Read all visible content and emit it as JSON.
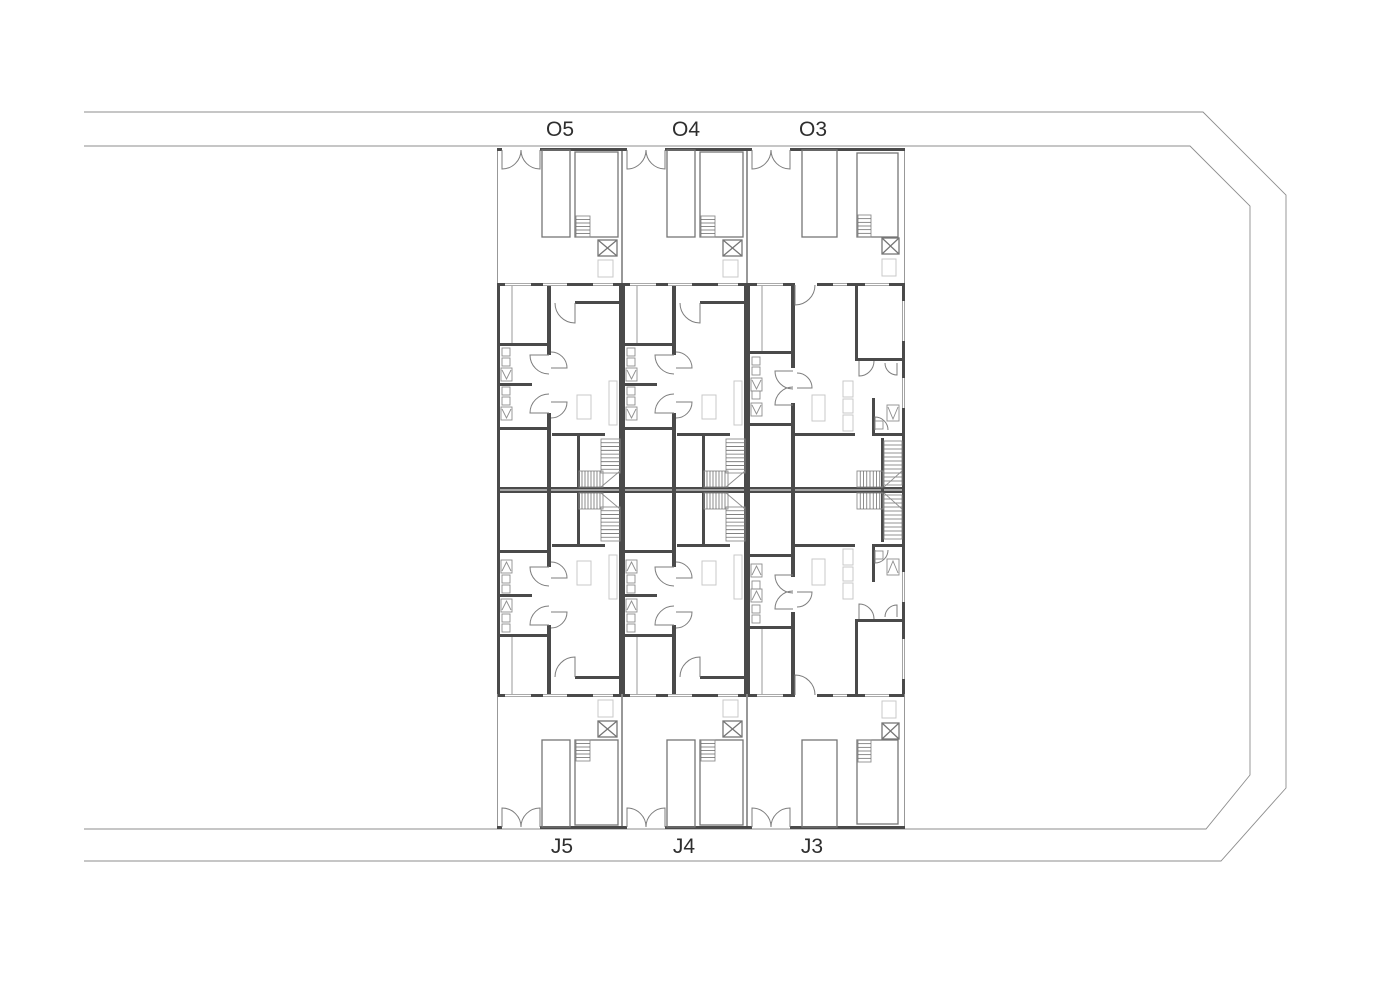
{
  "document": {
    "type": "architectural-site-floor-plan",
    "background": "#ffffff"
  },
  "labels": {
    "top_units": [
      "O5",
      "O4",
      "O3"
    ],
    "bottom_units": [
      "J5",
      "J4",
      "J3"
    ],
    "top_y": 136,
    "bottom_y": 853,
    "font_size": 21,
    "color": "#2e2e2e"
  },
  "colors": {
    "thin_line": "#8d8d8d",
    "medium_line": "#757575",
    "wall_fill": "#4a4a4a",
    "faint_detail": "#c9c9c9",
    "label_text": "#2e2e2e",
    "background": "#ffffff"
  },
  "drawing": {
    "canvas": {
      "w": 1400,
      "h": 989
    },
    "site_boundary": {
      "outer_path": "M 84 112 H 1203 L 1286 195 V 788 L 1221 861 H 84",
      "inner_path": "M 84 146 H 1190 L 1250 206 V 775 L 1206 829 H 84"
    },
    "rows": {
      "courtyard_top_y": 148,
      "dwelling_top_y": 283,
      "mid_y": 490,
      "dwelling_bottom_end": 697,
      "street_bottom_y": 829,
      "courtyard_h": 135,
      "dwelling_h": 207
    },
    "columns": [
      {
        "x": 497,
        "w": 125,
        "type": "A",
        "label_top": "O5",
        "label_bottom": "J5",
        "label_x_top": 560,
        "label_x_bottom": 562
      },
      {
        "x": 622,
        "w": 125,
        "type": "A",
        "label_top": "O4",
        "label_bottom": "J4",
        "label_x_top": 686,
        "label_x_bottom": 684
      },
      {
        "x": 747,
        "w": 158,
        "type": "B",
        "label_top": "O3",
        "label_bottom": "J3",
        "label_x_top": 813,
        "label_x_bottom": 812
      }
    ],
    "templates": {
      "A": {
        "courtyard": [
          [
            "l",
            0.5,
            0,
            0.5,
            135
          ],
          [
            "l",
            124.5,
            0,
            124.5,
            135
          ],
          [
            "w",
            0,
            0,
            5,
            3
          ],
          [
            "w",
            43,
            0,
            82,
            3
          ],
          [
            "a",
            5,
            2,
            19,
            "s",
            "e"
          ],
          [
            "a",
            43,
            2,
            19,
            "s",
            "w"
          ],
          [
            "r",
            45,
            2,
            28,
            87
          ],
          [
            "r",
            78,
            4,
            43,
            85
          ],
          [
            "hh",
            79,
            68,
            14,
            21,
            5
          ],
          [
            "x",
            101,
            92,
            19,
            16
          ],
          [
            "f",
            101,
            112,
            15,
            17
          ]
        ],
        "dwelling": [
          [
            "w",
            0,
            0,
            125,
            3
          ],
          [
            "w",
            0,
            0,
            3,
            207
          ],
          [
            "w",
            122,
            0,
            3,
            207
          ],
          [
            "w",
            0,
            204,
            125,
            2.5
          ],
          [
            "w",
            0,
            60,
            53,
            3
          ],
          [
            "w",
            0,
            100,
            35,
            3
          ],
          [
            "w",
            0,
            144,
            53,
            3
          ],
          [
            "w",
            50,
            0,
            4,
            72
          ],
          [
            "w",
            50,
            130,
            4,
            77
          ],
          [
            "w",
            78,
            18,
            47,
            3
          ],
          [
            "w",
            55,
            150,
            53,
            3
          ],
          [
            "w",
            80,
            153,
            3,
            51
          ],
          [
            "win",
            8,
            0,
            26,
            3
          ],
          [
            "win",
            46,
            0,
            24,
            3
          ],
          [
            "win",
            96,
            0,
            20,
            3
          ],
          [
            "l",
            15,
            3,
            15,
            60
          ],
          [
            "a",
            78,
            20,
            20,
            "s",
            "w"
          ],
          [
            "a",
            52,
            72,
            19,
            "w",
            "s"
          ],
          [
            "a",
            52,
            130,
            19,
            "w",
            "n"
          ],
          [
            "a",
            54,
            85,
            16,
            "e",
            "n"
          ],
          [
            "a",
            54,
            119,
            16,
            "e",
            "s"
          ],
          [
            "sq",
            5,
            65,
            8,
            8
          ],
          [
            "sq",
            5,
            75,
            8,
            8
          ],
          [
            "V",
            4,
            85,
            11,
            13
          ],
          [
            "sq",
            5,
            104,
            8,
            8
          ],
          [
            "sq",
            5,
            114,
            8,
            8
          ],
          [
            "V",
            4,
            124,
            11,
            13
          ],
          [
            "f",
            80,
            112,
            14,
            24
          ],
          [
            "f",
            112,
            98,
            8,
            44
          ],
          [
            "hh",
            104,
            156,
            19,
            34,
            8
          ],
          [
            "hv",
            82,
            188,
            24,
            16,
            7
          ],
          [
            "l",
            104,
            204,
            123,
            188
          ]
        ]
      },
      "B": {
        "courtyard": [
          [
            "l",
            0.5,
            0,
            0.5,
            135
          ],
          [
            "l",
            157.5,
            0,
            157.5,
            135
          ],
          [
            "w",
            0,
            0,
            5,
            3
          ],
          [
            "w",
            43,
            0,
            115,
            3
          ],
          [
            "a",
            5,
            2,
            19,
            "s",
            "e"
          ],
          [
            "a",
            43,
            2,
            19,
            "s",
            "w"
          ],
          [
            "r",
            55,
            2,
            35,
            87
          ],
          [
            "r",
            110,
            5,
            41,
            84
          ],
          [
            "hh",
            111,
            67,
            13,
            22,
            5
          ],
          [
            "x",
            135,
            90,
            17,
            16
          ],
          [
            "f",
            135,
            111,
            14,
            17
          ]
        ],
        "dwelling": [
          [
            "w",
            0,
            0,
            48,
            3
          ],
          [
            "w",
            70,
            0,
            88,
            3
          ],
          [
            "w",
            0,
            0,
            3,
            207
          ],
          [
            "w",
            155,
            0,
            3,
            207
          ],
          [
            "w",
            0,
            204,
            158,
            2.5
          ],
          [
            "w",
            0,
            68,
            44,
            3
          ],
          [
            "w",
            0,
            140,
            44,
            3
          ],
          [
            "w",
            44,
            0,
            4,
            85
          ],
          [
            "w",
            44,
            120,
            4,
            87
          ],
          [
            "w",
            108,
            0,
            3,
            78
          ],
          [
            "w",
            108,
            75,
            50,
            3
          ],
          [
            "w",
            125,
            115,
            3,
            38
          ],
          [
            "w",
            125,
            150,
            33,
            3
          ],
          [
            "w",
            48,
            150,
            60,
            3
          ],
          [
            "w",
            134,
            155,
            3,
            52
          ],
          [
            "win",
            10,
            0,
            26,
            3
          ],
          [
            "win",
            86,
            0,
            14,
            3
          ],
          [
            "win",
            118,
            0,
            24,
            3
          ],
          [
            "win",
            155,
            18,
            3,
            40
          ],
          [
            "win",
            155,
            95,
            3,
            30
          ],
          [
            "l",
            15,
            3,
            15,
            68
          ],
          [
            "a",
            48,
            2,
            20,
            "s",
            "e"
          ],
          [
            "a",
            46,
            88,
            18,
            "w",
            "s"
          ],
          [
            "a",
            46,
            122,
            18,
            "w",
            "n"
          ],
          [
            "a",
            50,
            105,
            15,
            "e",
            "n"
          ],
          [
            "a",
            112,
            78,
            15,
            "s",
            "e"
          ],
          [
            "a",
            150,
            80,
            12,
            "s",
            "w"
          ],
          [
            "a",
            128,
            147,
            13,
            "n",
            "e"
          ],
          [
            "sq",
            5,
            74,
            8,
            8
          ],
          [
            "sq",
            5,
            84,
            8,
            8
          ],
          [
            "V",
            4,
            95,
            11,
            13
          ],
          [
            "sq",
            5,
            108,
            8,
            8
          ],
          [
            "V",
            4,
            120,
            11,
            13
          ],
          [
            "f",
            96,
            98,
            10,
            16
          ],
          [
            "f",
            96,
            116,
            10,
            14
          ],
          [
            "f",
            96,
            132,
            10,
            16
          ],
          [
            "V",
            140,
            122,
            12,
            16
          ],
          [
            "sq",
            128,
            138,
            8,
            8
          ],
          [
            "f",
            65,
            112,
            13,
            26
          ],
          [
            "hh",
            137,
            158,
            18,
            44,
            10
          ],
          [
            "hv",
            110,
            188,
            26,
            16,
            7
          ],
          [
            "l",
            137,
            204,
            155,
            188
          ]
        ]
      }
    }
  }
}
